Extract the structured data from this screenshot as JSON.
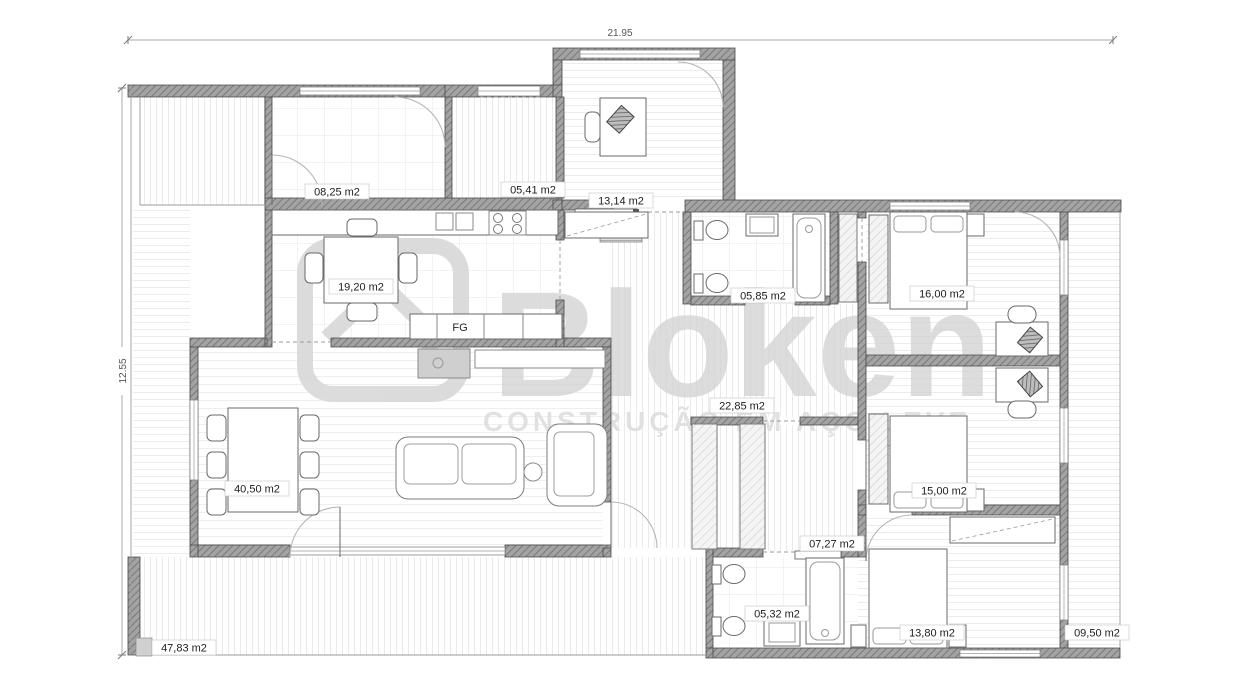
{
  "drawing": {
    "type": "floor-plan",
    "overall_width_label": "21.95",
    "overall_height_label": "12.55"
  },
  "watermark": {
    "brand": "Bloken",
    "tagline": "CONSTRUÇÃO EM AÇO LEVE"
  },
  "kitchen": {
    "appliance_label": "FG"
  },
  "rooms": [
    {
      "name": "bedroom-top-left",
      "area": "08,25 m2"
    },
    {
      "name": "entry-hall",
      "area": "05,41 m2"
    },
    {
      "name": "office",
      "area": "13,14 m2"
    },
    {
      "name": "kitchen-dining",
      "area": "19,20 m2"
    },
    {
      "name": "bathroom-top",
      "area": "05,85 m2"
    },
    {
      "name": "bedroom-top-right",
      "area": "16,00 m2"
    },
    {
      "name": "corridor",
      "area": "22,85 m2"
    },
    {
      "name": "living-room",
      "area": "40,50 m2"
    },
    {
      "name": "bedroom-middle-right",
      "area": "15,00 m2"
    },
    {
      "name": "hall-wardrobes",
      "area": "07,27 m2"
    },
    {
      "name": "bathroom-bottom",
      "area": "05,32 m2"
    },
    {
      "name": "bedroom-bottom-right",
      "area": "13,80 m2"
    },
    {
      "name": "deck-right",
      "area": "09,50 m2"
    },
    {
      "name": "deck-bottom",
      "area": "47,83 m2"
    }
  ]
}
